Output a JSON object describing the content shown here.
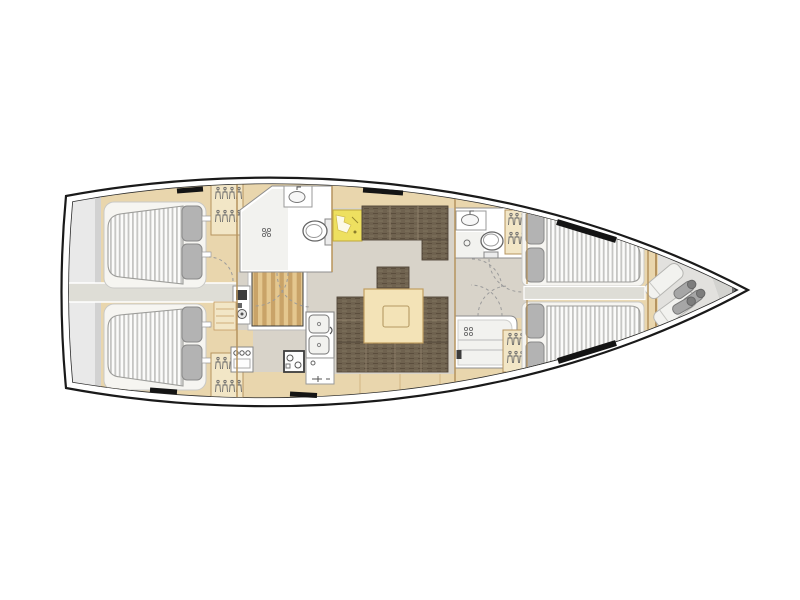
{
  "diagram": {
    "kind": "sailing-yacht-interior-floor-plan",
    "view": "top-down, bow pointing right",
    "rooms": [
      {
        "name": "transom-platform",
        "features": [
          "swim-platform"
        ]
      },
      {
        "name": "aft-cabin-port",
        "features": [
          "double-berth",
          "pillows",
          "hanging-locker",
          "door"
        ]
      },
      {
        "name": "aft-cabin-starboard",
        "features": [
          "double-berth",
          "pillows",
          "hanging-locker",
          "door"
        ]
      },
      {
        "name": "aft-corridor",
        "features": [
          "walkway"
        ]
      },
      {
        "name": "companionway",
        "features": [
          "stairs",
          "engine-panel"
        ]
      },
      {
        "name": "aft-head",
        "features": [
          "shower-floor",
          "sink",
          "toilet",
          "door-swing"
        ]
      },
      {
        "name": "galley",
        "features": [
          "double-sink",
          "stove",
          "oven-unit",
          "counters"
        ]
      },
      {
        "name": "nav-station",
        "features": [
          "chart-table"
        ]
      },
      {
        "name": "salon",
        "features": [
          "sofa",
          "u-shaped-settee",
          "dining-table",
          "stool"
        ]
      },
      {
        "name": "forward-head",
        "features": [
          "sink",
          "toilet",
          "shower-floor",
          "door-swing"
        ]
      },
      {
        "name": "forward-shower-room",
        "features": [
          "shower-seat",
          "drain",
          "door-swing"
        ]
      },
      {
        "name": "forward-cabin",
        "features": [
          "twin-berths",
          "pillows",
          "hanging-lockers",
          "center-aisle"
        ]
      },
      {
        "name": "bow-sail-locker",
        "features": [
          "sail-bags",
          "fenders"
        ]
      }
    ],
    "deck_hatches": 6
  },
  "colors": {
    "hull_line": "#1a1a1a",
    "inner_line": "#2b2b2b",
    "wood": "#e9d6ad",
    "wood_light": "#f2e6c6",
    "wood_mid": "#ddc08a",
    "wood_dark": "#c59c62",
    "plank_a": "#e4c78f",
    "plank_b": "#c9a368",
    "floor": "#d8d3c9",
    "corridor": "#deddd6",
    "transom": "#e9e9e9",
    "transom_edge": "#d2d2d2",
    "bow_gray": "#e2e1de",
    "bow_gray2": "#d3d3d0",
    "white": "#ffffff",
    "pale": "#f2f2ef",
    "mattress": "#fbfbfa",
    "stripe": "#c5c5c3",
    "mattress_edge": "#9d9d9a",
    "pillow": "#b3b3b3",
    "pillow_dark": "#8a8a8a",
    "settee": "#6f624f",
    "weave_light": "#82755f",
    "weave_dark": "#594b3b",
    "table": "#f3e3b7",
    "table_edge": "#c19e60",
    "chart": "#eee060",
    "chart_edge": "#c0a93c",
    "wall": "#b6945f",
    "fixture": "#8e8e8e",
    "dark": "#3c3c3c",
    "metal": "#6f6f6f",
    "arc": "#9b9b9b",
    "hatch": "#141414",
    "frame": "#c9c9c6",
    "fender": "#a6a6a6",
    "fender_cap": "#7d7d7d"
  }
}
